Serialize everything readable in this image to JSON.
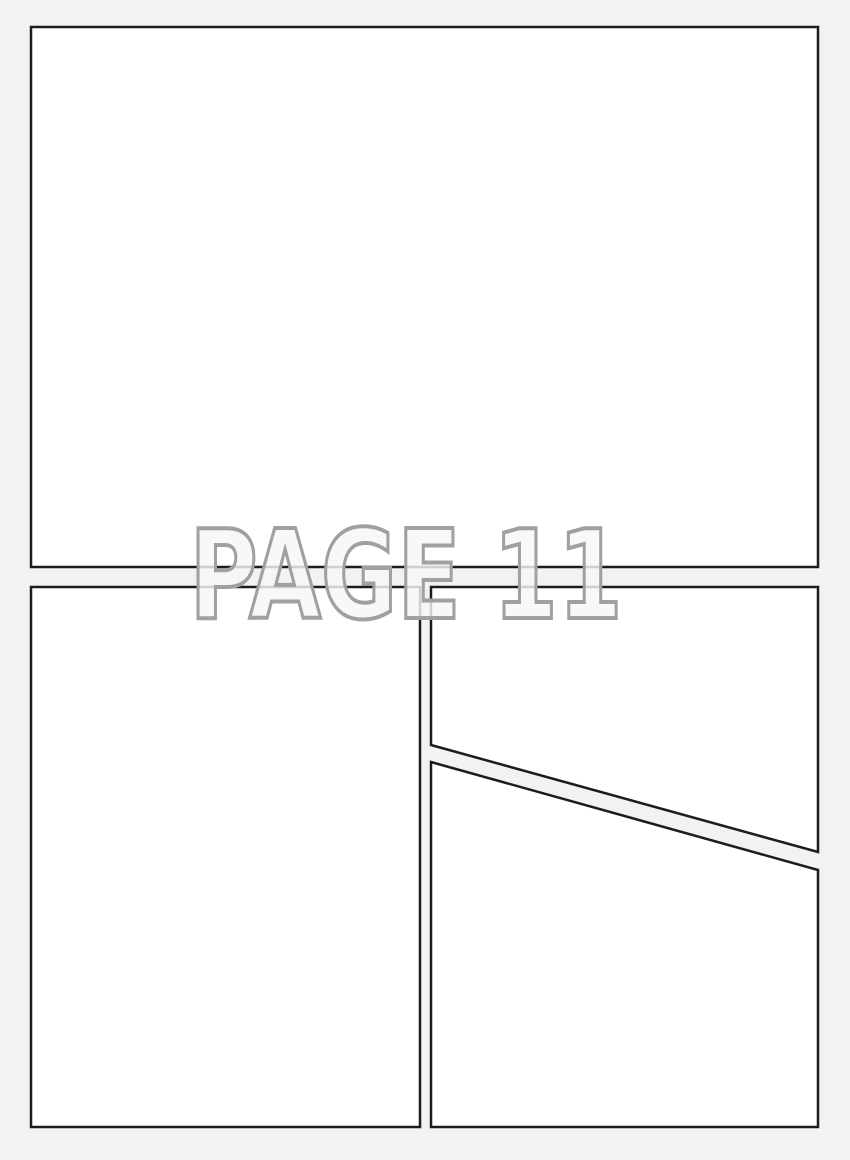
{
  "page": {
    "label": "PAGE 11"
  },
  "colors": {
    "background": "#f2f2f2",
    "panel_fill": "#ffffff",
    "panel_border": "#1c1c1c",
    "label_fill": "#f6f6f6",
    "label_outline": "#a0a0a0"
  }
}
